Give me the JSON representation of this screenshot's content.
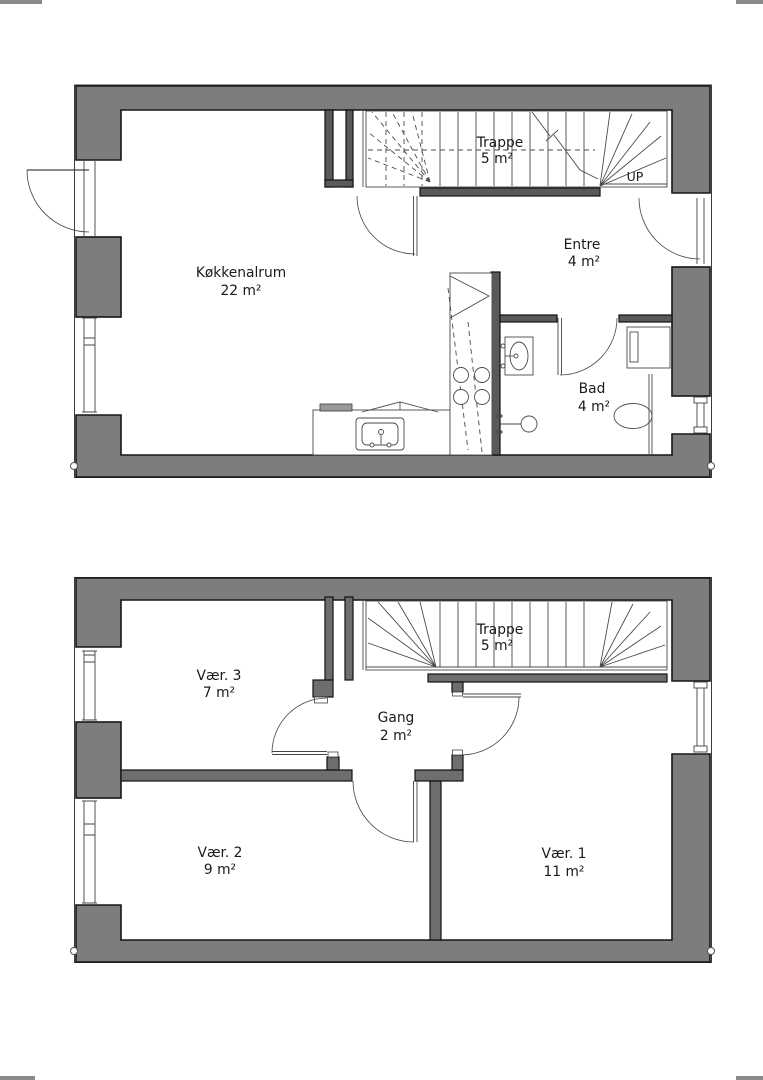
{
  "drawing": {
    "kind": "floor-plan",
    "stair_direction_label": "UP"
  },
  "floors": [
    {
      "position": "top-plan",
      "rooms": [
        {
          "name": "Køkkenalrum",
          "area": "22 m²"
        },
        {
          "name": "Trappe",
          "area": "5 m²"
        },
        {
          "name": "Entre",
          "area": "4 m²"
        },
        {
          "name": "Bad",
          "area": "4 m²"
        }
      ]
    },
    {
      "position": "bottom-plan",
      "rooms": [
        {
          "name": "Vær. 3",
          "area": "7 m²"
        },
        {
          "name": "Trappe",
          "area": "5 m²"
        },
        {
          "name": "Gang",
          "area": "2 m²"
        },
        {
          "name": "Vær. 2",
          "area": "9 m²"
        },
        {
          "name": "Vær. 1",
          "area": "11 m²"
        }
      ]
    }
  ],
  "colors": {
    "background": "#ffffff",
    "exterior_wall_fill": "#7d7d7d",
    "interior_wall_fill_dark": "#5a5a5a",
    "interior_wall_fill": "#6e6e6e",
    "outline": "#1a1a1a",
    "thin_line": "#444444",
    "fixture_accent": "#999999"
  }
}
